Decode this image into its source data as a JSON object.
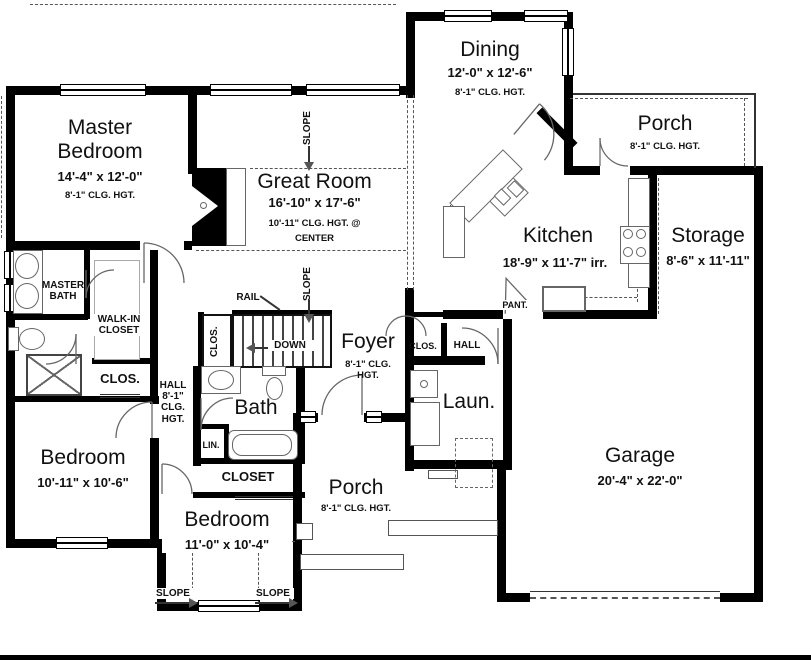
{
  "colors": {
    "wall": "#000000",
    "line": "#555555",
    "text": "#111111",
    "bg": "#ffffff"
  },
  "rooms": {
    "master_bedroom": {
      "name": "Master Bedroom",
      "dims": "14'-4\" x 12'-0\"",
      "ceiling": "8'-1\" CLG. HGT."
    },
    "great_room": {
      "name": "Great Room",
      "dims": "16'-10\" x 17'-6\"",
      "ceiling": "10'-11\" CLG. HGT. @",
      "ceiling2": "CENTER"
    },
    "dining": {
      "name": "Dining",
      "dims": "12'-0\" x 12'-6\"",
      "ceiling": "8'-1\" CLG. HGT."
    },
    "porch_rear": {
      "name": "Porch",
      "ceiling": "8'-1\" CLG. HGT."
    },
    "kitchen": {
      "name": "Kitchen",
      "dims": "18'-9\" x 11'-7\" irr."
    },
    "storage": {
      "name": "Storage",
      "dims": "8'-6\" x 11'-11\""
    },
    "garage": {
      "name": "Garage",
      "dims": "20'-4\" x 22'-0\""
    },
    "foyer": {
      "name": "Foyer",
      "ceiling": "8'-1\" CLG. HGT."
    },
    "laundry": {
      "name": "Laun."
    },
    "bath": {
      "name": "Bath"
    },
    "master_bath": {
      "name": "MASTER BATH"
    },
    "walk_in_closet": {
      "name": "WALK-IN CLOSET"
    },
    "closet_master": {
      "name": "CLOS."
    },
    "hall_bedrooms": {
      "name": "HALL 8'-1\" CLG. HGT."
    },
    "closet_stairs": {
      "name": "CLOS."
    },
    "bedroom_left": {
      "name": "Bedroom",
      "dims": "10'-11\" x 10'-6\""
    },
    "bedroom_rear": {
      "name": "Bedroom",
      "dims": "11'-0\" x 10'-4\""
    },
    "closet_bedroom": {
      "name": "CLOSET"
    },
    "linen": {
      "name": "LIN."
    },
    "porch_front": {
      "name": "Porch",
      "ceiling": "8'-1\" CLG. HGT."
    },
    "pantry": {
      "name": "PANT."
    },
    "hall_garage": {
      "name": "HALL"
    },
    "closet_foyer": {
      "name": "CLOS."
    }
  },
  "annotations": {
    "rail": "RAIL",
    "down": "DOWN",
    "slope": "SLOPE"
  }
}
